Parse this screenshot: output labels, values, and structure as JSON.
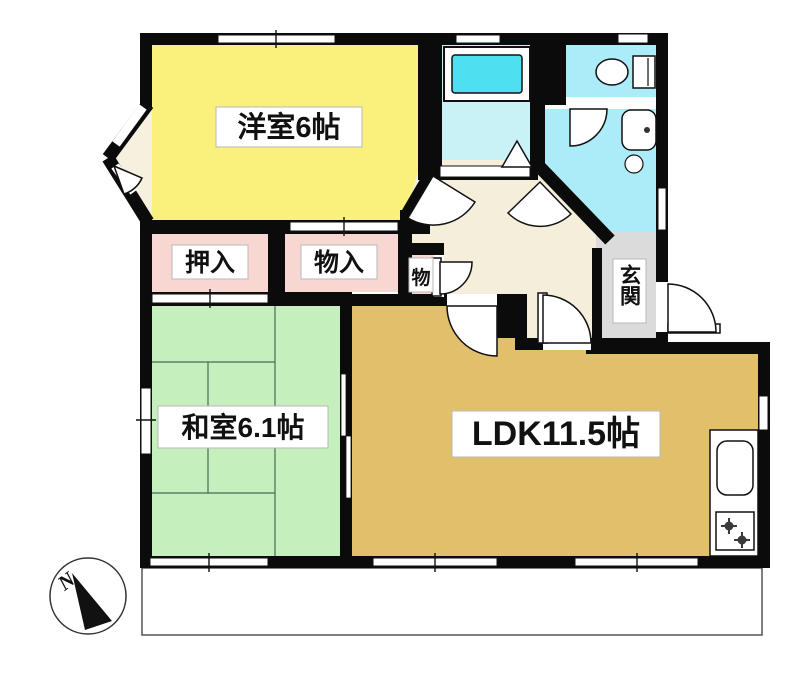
{
  "title": "apartment-floor-plan",
  "wall_color": "#0b0b0b",
  "rooms": {
    "western_room": {
      "label": "洋室6帖",
      "color": "#F9F17C"
    },
    "japanese_room": {
      "label": "和室6.1帖",
      "color": "#C6EFBE"
    },
    "ldk": {
      "label": "LDK11.5帖",
      "color": "#E2BF6A"
    },
    "closet_oshiire": {
      "label": "押入",
      "color": "#F8D7D3"
    },
    "closet_monoire": {
      "label": "物入",
      "color": "#F8D7D3"
    },
    "closet_mono": {
      "label": "物",
      "color": "#F8D7D3"
    },
    "entrance": {
      "label": "玄関",
      "color": "#DBDBDB"
    },
    "bathroom": {
      "color": "#C9F2F7",
      "tub_color": "#4EE0F1"
    },
    "toilet_room": {
      "color": "#ACECF9"
    },
    "washroom": {
      "color": "#ACECF9"
    },
    "hallway": {
      "color": "#F4EEDB"
    },
    "bay_alcove": {
      "color": "#F6F0DE"
    }
  },
  "fixtures": {
    "balcony_color": "#ffffff",
    "fixture_fill": "#ffffff",
    "burner_color": "#3a3a3a"
  },
  "compass": {
    "label": "N"
  }
}
